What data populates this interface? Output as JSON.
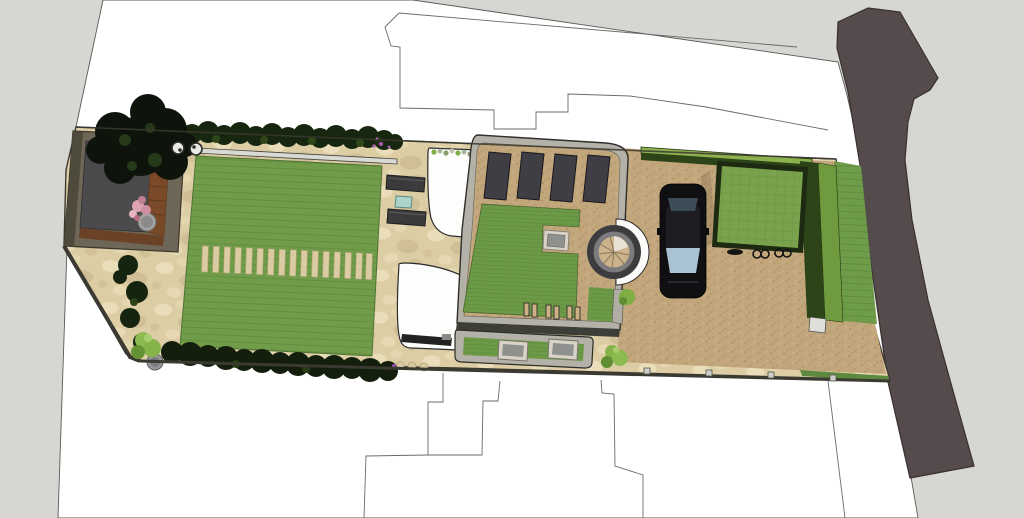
{
  "app": {
    "title": "3D garden landscape plan - top view render"
  },
  "canvas": {
    "width_px": 1024,
    "height_px": 518
  },
  "scene": {
    "description": "Top-down SketchUp-style 3D rendering of a long residential plot landscape design between neighbouring plot outlines and a road",
    "palette": {
      "background": "#d6d6d2",
      "survey_paper": "#ffffff",
      "outline_lines": "#6b6b6b",
      "road": "#564b4c",
      "garden_paving": "#dccda4",
      "driveway_paving": "#c3a77c",
      "lawn": "#6f9c49",
      "lawn_stripe": "#5e8b3d",
      "hedge_dark": "#17260f",
      "clipped_hedge_top": "#8db04f",
      "clipped_hedge_face": "#2c4417",
      "shed_roof": "#4b4b4e",
      "shed_wood_deck": "#794928",
      "tree_canopy": "#0e140b",
      "pink_shrub": "#dca3b2",
      "house_parapet": "#b4b1a9",
      "roof_deck": "#c8ad81",
      "solar_panel": "#3e3e44",
      "green_roof": "#6d9a47",
      "skylight_glass": "#8f918e",
      "spiral_stair_ring": "#3c3c3e",
      "car_body": "#101013",
      "car_windshield": "#a9c3d4",
      "carport_roof": "#7aa24d",
      "white_curved_wall": "#fdfdfc",
      "bench": "#3b3b3d",
      "teal_table": "#abd3c9",
      "boundary_wall": "#3b3a32"
    },
    "elements": [
      {
        "name": "neighboring-plot-outlines",
        "type": "thin line drawing on white survey paper"
      },
      {
        "name": "road",
        "side": "right"
      },
      {
        "name": "garden-shed",
        "position": "far left",
        "features": [
          "dark flat roof",
          "wood plank deck edge"
        ]
      },
      {
        "name": "large-tree",
        "position": "over shed"
      },
      {
        "name": "bistro-set-circles",
        "count": 2
      },
      {
        "name": "flowering-shrub-pink-in-pot",
        "count": 1
      },
      {
        "name": "boxwood-hedge-rows",
        "count": 2
      },
      {
        "name": "lawn-with-stepping-stones",
        "slat_count": 16
      },
      {
        "name": "potted-light-green-shrubs",
        "count": 2
      },
      {
        "name": "garden-benches",
        "count": 2
      },
      {
        "name": "teal-side-table",
        "count": 1
      },
      {
        "name": "white-curved-walls",
        "count": 2
      },
      {
        "name": "house-roof-terrace",
        "features": [
          "4 solar panels",
          "sedum green roof",
          "skylight",
          "spiral staircase tower",
          "6 roof vents",
          "lower green roof with 2 skylights"
        ]
      },
      {
        "name": "car",
        "color_desc": "black, parked facing down"
      },
      {
        "name": "carport-green-roof",
        "contents": "bicycles under edge"
      },
      {
        "name": "clipped-hedge-L-shape",
        "position": "around driveway"
      },
      {
        "name": "grass-verge-and-sidewalk",
        "position": "between plot and road"
      },
      {
        "name": "boundary-wall-with-posts",
        "position": "bottom edge"
      }
    ]
  }
}
